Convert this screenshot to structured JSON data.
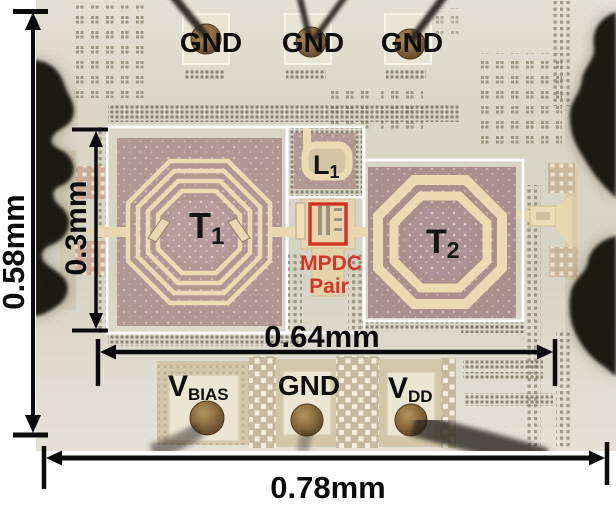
{
  "figure": {
    "description": "chip die micrograph with annotations",
    "top_pads": [
      "GND",
      "GND",
      "GND"
    ],
    "bottom_pads": [
      {
        "main": "V",
        "sub": "BIAS"
      },
      {
        "main": "GND",
        "sub": ""
      },
      {
        "main": "V",
        "sub": "DD"
      }
    ],
    "components": {
      "t1": {
        "main": "T",
        "sub": "1"
      },
      "t2": {
        "main": "T",
        "sub": "2"
      },
      "l1": {
        "main": "L",
        "sub": "1"
      },
      "mpdc": {
        "line1": "MPDC",
        "line2": "Pair"
      }
    },
    "dimensions": {
      "die_height": "0.58mm",
      "core_height": "0.3mm",
      "core_width": "0.64mm",
      "die_width": "0.78mm"
    },
    "colors": {
      "annotation_red": "#d2362a",
      "annotation_black": "#0b0b0b",
      "outline_white": "#ffffff",
      "die_background": "#dbd7c9",
      "inductor_metal": "#ecdbb2",
      "transformer_body": "#b29694",
      "bond_ball_brown": "#8f6f42"
    }
  }
}
